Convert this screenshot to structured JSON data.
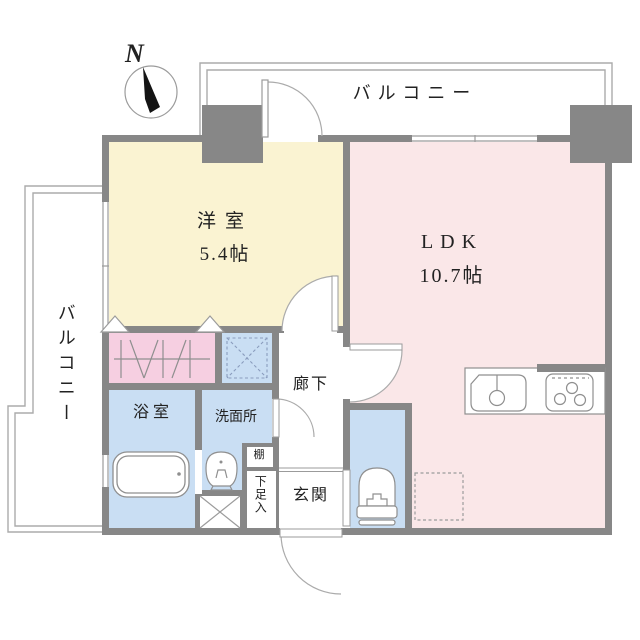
{
  "compass": {
    "north_label": "N"
  },
  "rooms": {
    "balcony_top": {
      "label": "バルコニー"
    },
    "balcony_left": {
      "label": "バルコニー"
    },
    "western_room": {
      "label": "洋室",
      "size": "5.4帖"
    },
    "ldk": {
      "label": "LDK",
      "size": "10.7帖"
    },
    "hallway": {
      "label": "廊下"
    },
    "bathroom": {
      "label": "浴室"
    },
    "washroom": {
      "label": "洗面所"
    },
    "shelf": {
      "label": "棚"
    },
    "shoe_cabinet": {
      "label": "下足入"
    },
    "entrance": {
      "label": "玄関"
    }
  },
  "colors": {
    "wall": "#878787",
    "western_room": "#faf3d2",
    "ldk": "#fae7e8",
    "closet": "#f6cfe1",
    "wet_rooms": "#c9def3",
    "ink": "#222222"
  }
}
